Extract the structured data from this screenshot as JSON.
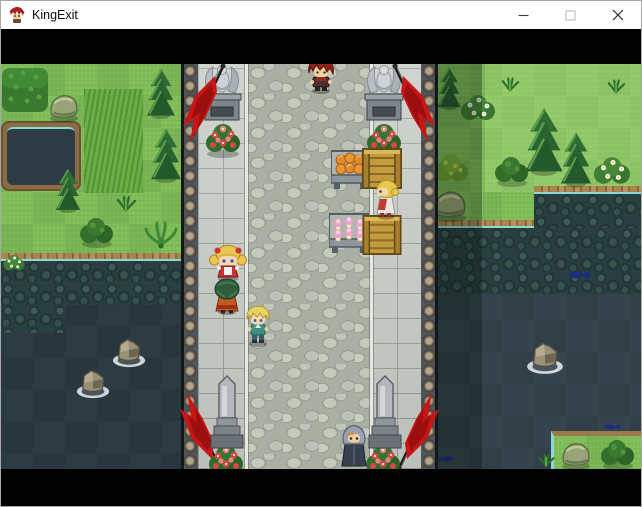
{
  "window": {
    "title": "KingExit",
    "icon": "red-haired-hero-icon",
    "controls": {
      "minimize": "Minimize",
      "maximize": "Maximize",
      "close": "Close"
    }
  },
  "game": {
    "view": "top-down RPG map, stone bridge crossing a dark river",
    "letterbox": "black bars above and below the map",
    "npcs": [
      "red-haired villager at top of bridge",
      "blonde girl with pigtails and red bows on left walkway",
      "green-haired villager in orange robe on left walkway",
      "blonde hero in teal tunic on the road",
      "blonde market vendor beside stall",
      "grey hooded figure at bottom of bridge"
    ],
    "objects": [
      "angel statue on pedestal (left)",
      "angel statue on pedestal (right)",
      "red banner flag x4",
      "red flower bush x4",
      "memorial obelisk x2",
      "wooden crate x2",
      "stall table with bread buns",
      "stall table with pink cakes",
      "pond in left meadow",
      "boulders in river",
      "conifer trees and bushes",
      "blue fish in river",
      "grass islet bottom-right"
    ],
    "palette": {
      "titlebar": "#ffffff",
      "letterbox": "#000000",
      "grass": "#80bd58",
      "river": "#35444d",
      "brick": "#c6cac4",
      "cobblestone": "#a9afa3",
      "flag_red": "#c81616",
      "crate_wood": "#c29b3e",
      "bread_orange": "#e08a2e",
      "cake_pink": "#f29fc4"
    }
  }
}
